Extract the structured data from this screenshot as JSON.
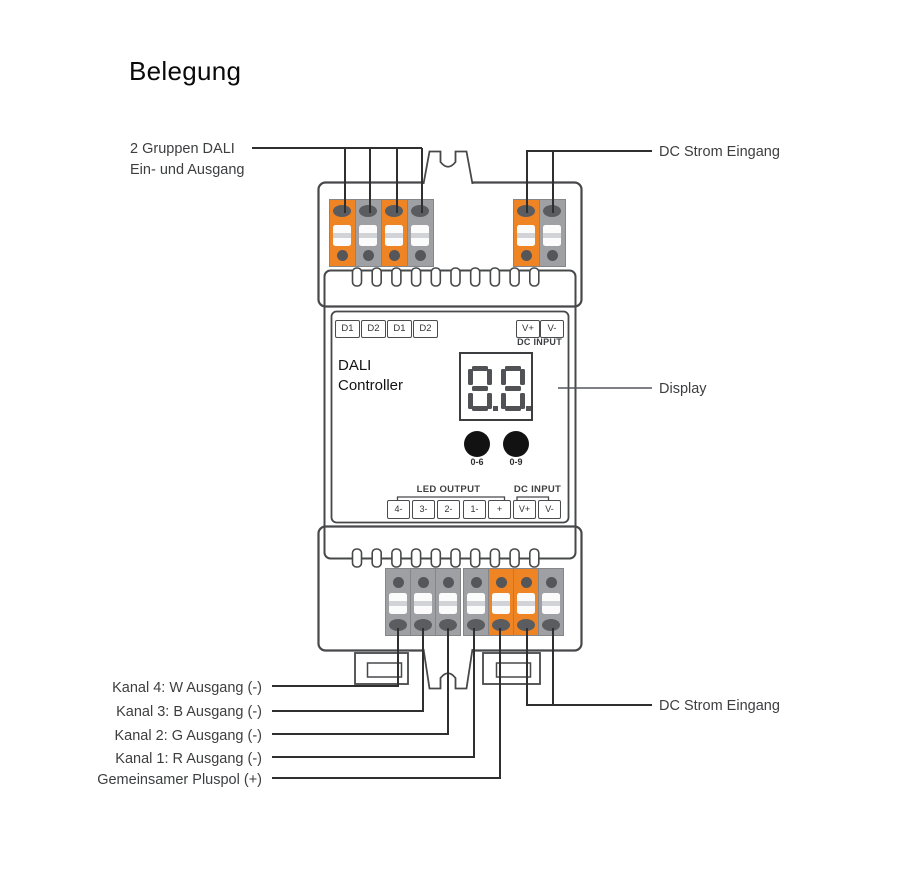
{
  "title": "Belegung",
  "callouts": {
    "dali_io": {
      "line1": "2 Gruppen DALI",
      "line2": "Ein- und Ausgang"
    },
    "dc_in_top": "DC Strom Eingang",
    "display": "Display",
    "dc_in_bottom": "DC Strom Eingang",
    "channels": [
      "Kanal 4: W Ausgang (-)",
      "Kanal 3: B Ausgang (-)",
      "Kanal 2: G Ausgang (-)",
      "Kanal 1: R Ausgang (-)",
      "Gemeinsamer Pluspol (+)"
    ]
  },
  "device": {
    "name": {
      "line1": "DALI",
      "line2": "Controller"
    },
    "dali_ports": [
      "D1",
      "D2",
      "D1",
      "D2"
    ],
    "dc_input_top": {
      "plus": "V+",
      "minus": "V-",
      "caption": "DC INPUT"
    },
    "display_value": "8.8.",
    "buttons": {
      "left": "0-6",
      "right": "0-9"
    },
    "led_output_caption": "LED OUTPUT",
    "dc_input_caption": "DC INPUT",
    "output_ports": [
      "4-",
      "3-",
      "2-",
      "1-",
      "+",
      "V+",
      "V-"
    ]
  },
  "colors": {
    "terminal_orange": "#EE8424",
    "terminal_gray": "#9EA0A3",
    "terminal_detail": "#58595B",
    "outline": "#47484A",
    "wire": "#2F2F2F",
    "text": "#3D3E40"
  }
}
